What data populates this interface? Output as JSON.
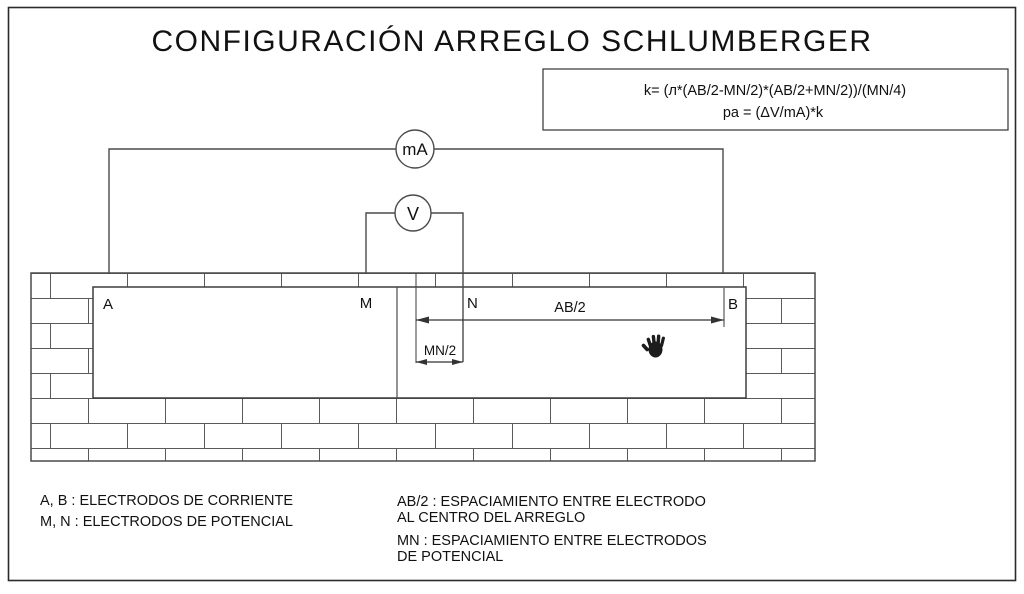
{
  "title": "CONFIGURACIÓN ARREGLO SCHLUMBERGER",
  "formula_box": {
    "k_formula": "k=  (л*(AB/2-MN/2)*(AB/2+MN/2))/(MN/4)",
    "pa_formula": "pa  =  (ΔV/mA)*k"
  },
  "meters": {
    "ammeter_label": "mA",
    "voltmeter_label": "V"
  },
  "electrodes": {
    "a_label": "A",
    "m_label": "M",
    "n_label": "N",
    "b_label": "B"
  },
  "dimensions": {
    "ab2_label": "AB/2",
    "mn2_label": "MN/2"
  },
  "legend": {
    "current_electrodes": "A, B : ELECTRODOS DE CORRIENTE",
    "potential_electrodes": "M, N : ELECTRODOS DE POTENCIAL",
    "ab2_line1": "AB/2 : ESPACIAMIENTO ENTRE ELECTRODO",
    "ab2_line2": "AL CENTRO DEL ARREGLO",
    "mn_line1": "MN : ESPACIAMIENTO ENTRE ELECTRODOS",
    "mn_line2": "DE POTENCIAL"
  },
  "icons": {
    "hand": "grab-hand-cursor"
  },
  "colors": {
    "line": "#4a4a4a",
    "brick_line": "#5a5a5a",
    "text": "#111111",
    "background": "#ffffff"
  }
}
